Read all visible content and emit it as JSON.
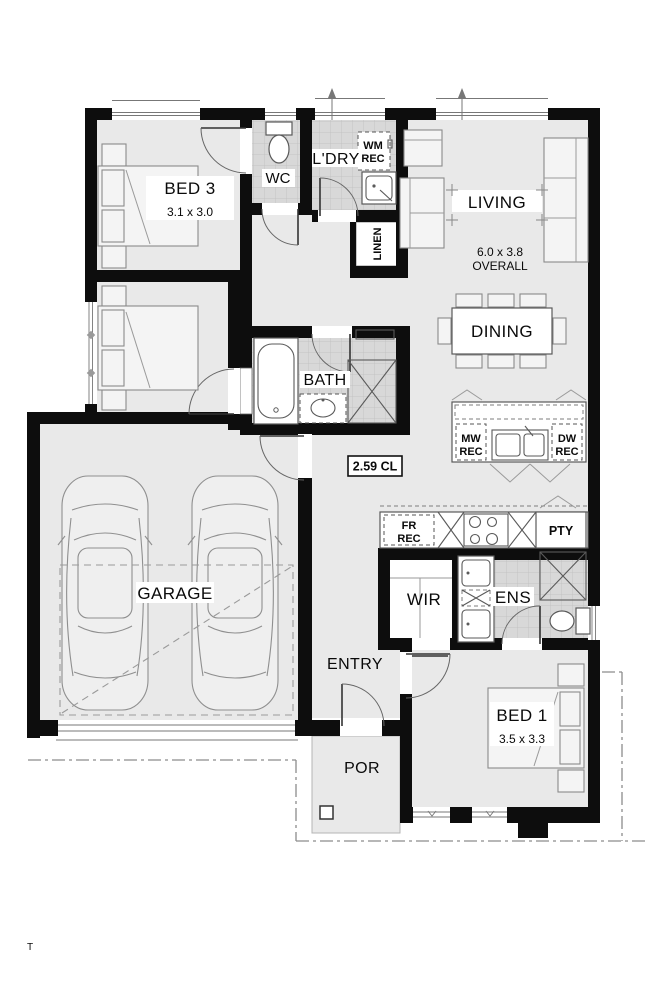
{
  "plan": {
    "rooms": {
      "bed3": {
        "name": "BED 3",
        "dims": "3.1 x 3.0"
      },
      "bed2": {
        "name": "BED 2",
        "dims": "3.1 x 3.0"
      },
      "bed1": {
        "name": "BED 1",
        "dims": "3.5 x 3.3"
      },
      "living": {
        "name": "LIVING",
        "dims": "6.0 x 3.8",
        "suffix": "OVERALL"
      },
      "dining": {
        "name": "DINING"
      },
      "garage": {
        "name": "GARAGE"
      },
      "entry": {
        "name": "ENTRY"
      },
      "porch": {
        "name": "POR"
      },
      "bath": {
        "name": "BATH"
      },
      "wc": {
        "name": "WC"
      },
      "laundry": {
        "name": "L'DRY"
      },
      "linen": {
        "name": "LINEN"
      },
      "wir": {
        "name": "WIR"
      },
      "ens": {
        "name": "ENS"
      },
      "pantry": {
        "name": "PTY"
      }
    },
    "recesses": {
      "wm": {
        "l1": "WM",
        "l2": "REC"
      },
      "mw": {
        "l1": "MW",
        "l2": "REC"
      },
      "dw": {
        "l1": "DW",
        "l2": "REC"
      },
      "fr": {
        "l1": "FR",
        "l2": "REC"
      }
    },
    "ceiling_height": "2.59 CL",
    "watermark": "T",
    "colors": {
      "wall": "#0d0d0d",
      "floor": "#e9e9e9",
      "tile": "#d8d8d8",
      "tile_grid": "#c3c3c3",
      "fixture_outline": "#5a5a5a",
      "boundary": "#8c8c8c",
      "background": "#ffffff"
    }
  }
}
